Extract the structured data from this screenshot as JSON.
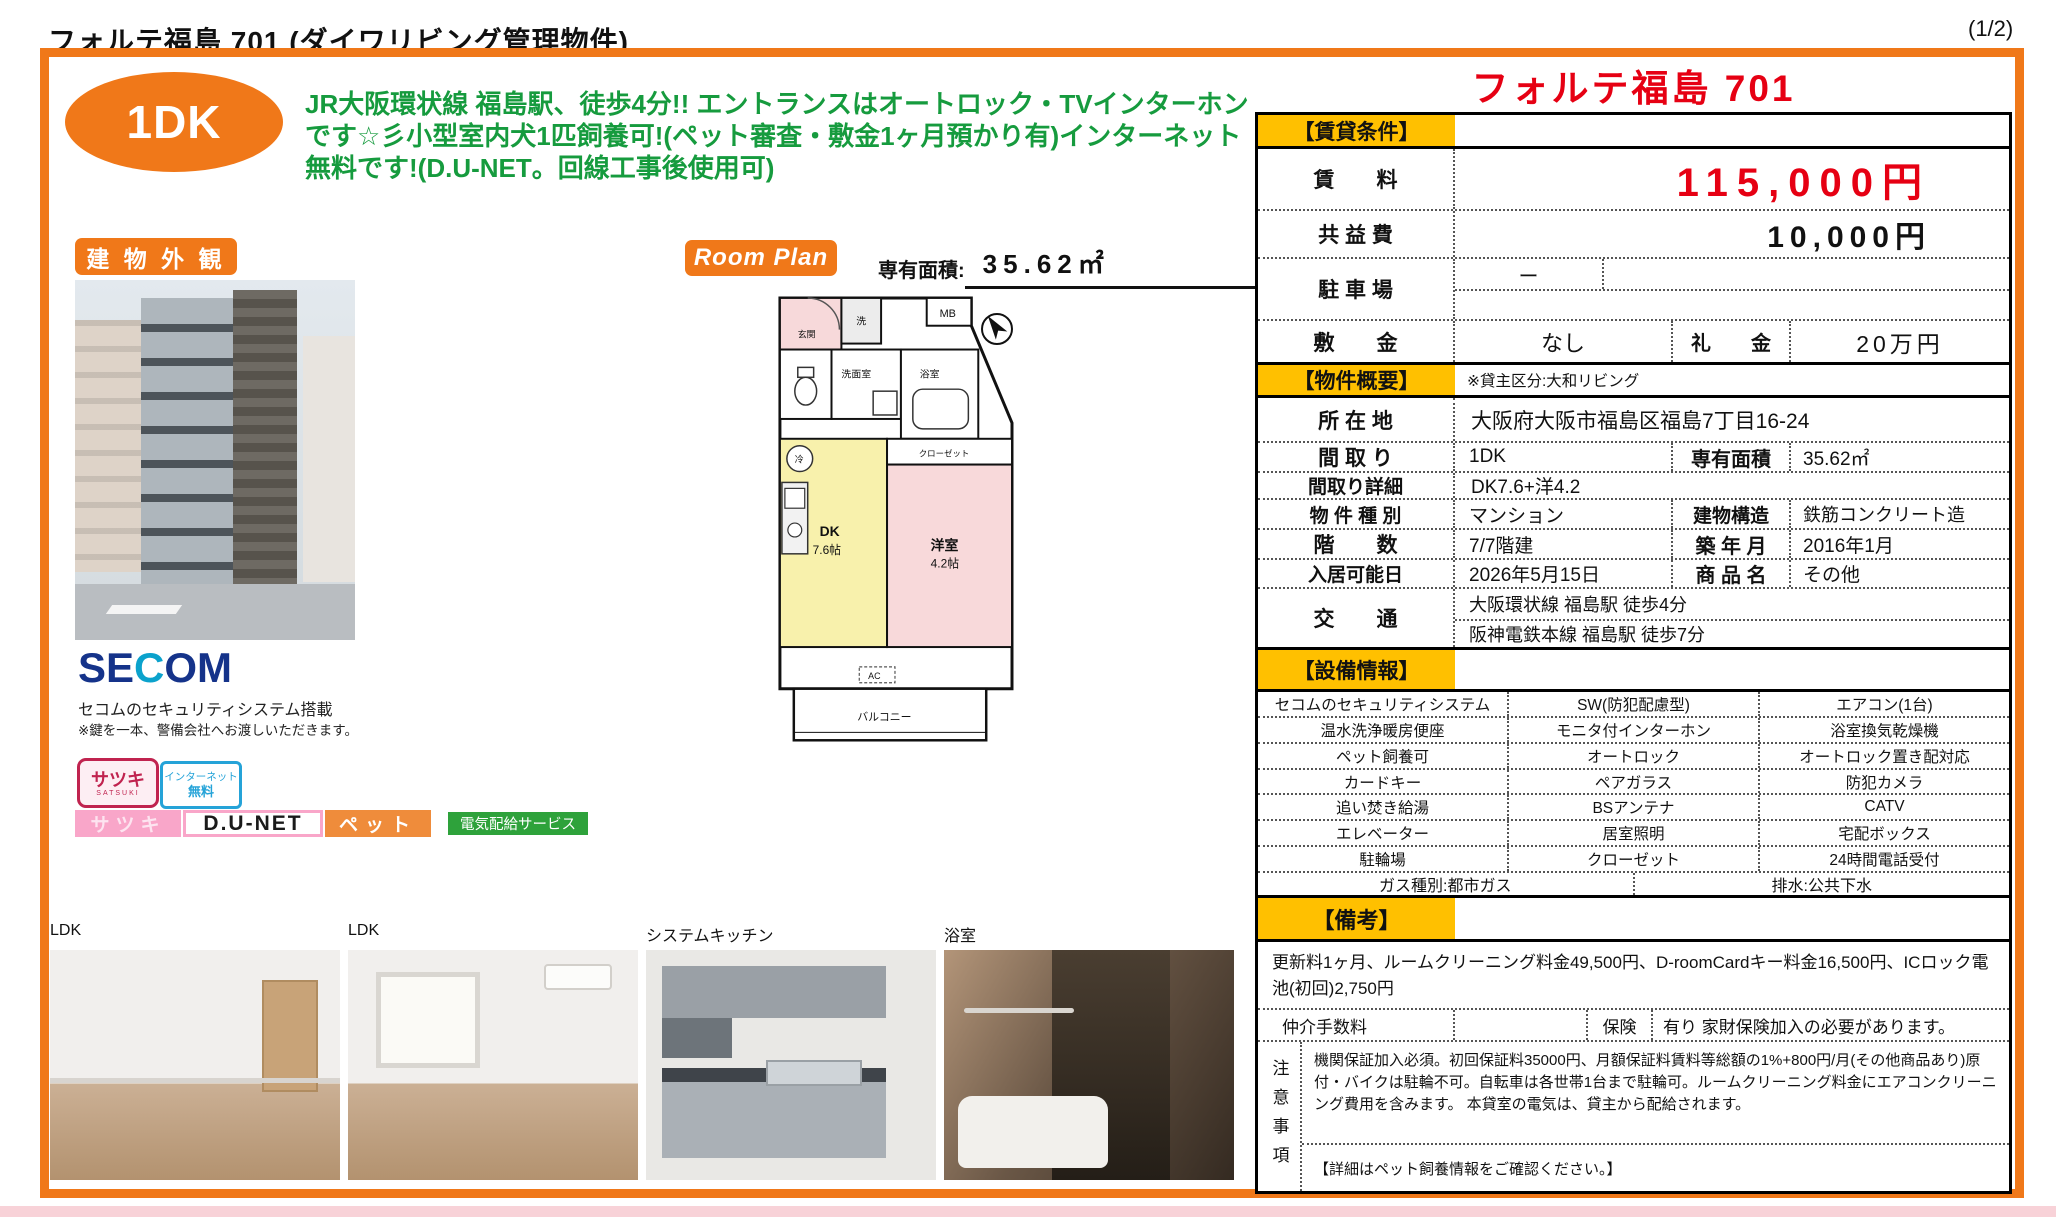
{
  "colors": {
    "frame_orange": "#f07819",
    "section_yellow": "#ffc000",
    "price_red": "#e60013",
    "headline_green": "#169b3e",
    "secom_blue": "#15338a",
    "secom_teal": "#0ba2cc",
    "badge_pink": "#f9a6c9",
    "badge_orange": "#ef8c3b",
    "badge_green": "#2ea23b"
  },
  "header": {
    "title": "フォルテ福島 701 (ダイワリビング管理物件)",
    "page": "(1/2)"
  },
  "hero": {
    "type_badge": "1DK",
    "headline": "JR大阪環状線 福島駅、徒歩4分!! エントランスはオートロック・TVインターホンです☆彡小型室内犬1匹飼養可!(ペット審査・敷金1ヶ月預かり有)インターネット無料です!(D.U-NET。回線工事後使用可)"
  },
  "left": {
    "exterior_label": "建 物 外 観",
    "secom": {
      "logo_parts": [
        "SE",
        "C",
        "OM"
      ],
      "line1": "セコムのセキュリティシステム搭載",
      "line2": "※鍵を一本、警備会社へお渡しいただきます。"
    },
    "badges": {
      "satsuki_stamp": "サツキ",
      "satsuki_sub": "SATSUKI",
      "internet1": "インターネット",
      "internet2": "無料",
      "satsuki_bar": "サツキ",
      "dunet": "D.U-NET",
      "pet": "ペット",
      "electric": "電気配給サービス"
    }
  },
  "floorplan": {
    "label": "Room Plan",
    "area_label": "専有面積:",
    "area_value": "35.62㎡",
    "rooms": {
      "mb": "MB",
      "entrance": "玄関",
      "washer": "洗",
      "washroom": "洗面室",
      "bath": "浴室",
      "fridge": "冷",
      "closet": "クローゼット",
      "dk": "DK",
      "dk_size": "7.6帖",
      "western": "洋室",
      "western_size": "4.2帖",
      "ac": "AC",
      "balcony": "バルコニー"
    }
  },
  "photos": [
    {
      "label": "LDK"
    },
    {
      "label": "LDK"
    },
    {
      "label": "システムキッチン"
    },
    {
      "label": "浴室"
    }
  ],
  "panel": {
    "title": "フォルテ福島 701",
    "sec_rental": "【賃貸条件】",
    "rent_label": "賃　　料",
    "rent_value": "115,000円",
    "fee_label": "共 益 費",
    "fee_value": "10,000円",
    "parking_label": "駐 車 場",
    "parking_value": "ー",
    "deposit_label": "敷　　金",
    "deposit_value": "なし",
    "key_label": "礼　　金",
    "key_value": "20万円",
    "sec_overview": "【物件概要】",
    "overview_note": "※貸主区分:大和リビング",
    "address_label": "所 在 地",
    "address_value": "大阪府大阪市福島区福島7丁目16-24",
    "layout_label": "間 取 り",
    "layout_value": "1DK",
    "area_label": "専有面積",
    "area_value": "35.62㎡",
    "detail_label": "間取り詳細",
    "detail_value": "DK7.6+洋4.2",
    "type_label": "物 件 種 別",
    "type_value": "マンション",
    "structure_label": "建物構造",
    "structure_value": "鉄筋コンクリート造",
    "floors_label": "階　　数",
    "floors_value": "7/7階建",
    "built_label": "築 年 月",
    "built_value": "2016年1月",
    "movein_label": "入居可能日",
    "movein_value": "2026年5月15日",
    "product_label": "商 品 名",
    "product_value": "その他",
    "access_label": "交　　通",
    "access1": "大阪環状線 福島駅 徒歩4分",
    "access2": "阪神電鉄本線 福島駅 徒歩7分",
    "sec_equipment": "【設備情報】",
    "equipment": [
      [
        "セコムのセキュリティシステム",
        "SW(防犯配慮型)",
        "エアコン(1台)"
      ],
      [
        "温水洗浄暖房便座",
        "モニタ付インターホン",
        "浴室換気乾燥機"
      ],
      [
        "ペット飼養可",
        "オートロック",
        "オートロック置き配対応"
      ],
      [
        "カードキー",
        "ペアガラス",
        "防犯カメラ"
      ],
      [
        "追い焚き給湯",
        "BSアンテナ",
        "CATV"
      ],
      [
        "エレベーター",
        "居室照明",
        "宅配ボックス"
      ],
      [
        "駐輪場",
        "クローゼット",
        "24時間電話受付"
      ]
    ],
    "gas": "ガス種別:都市ガス",
    "drain": "排水:公共下水",
    "sec_remarks": "【備考】",
    "remarks": "更新料1ヶ月、ルームクリーニング料金49,500円、D-roomCardキー料金16,500円、ICロック電池(初回)2,750円",
    "broker_label": "仲介手数料",
    "insurance_label": "保険",
    "insurance_value": "有り 家財保険加入の必要があります。",
    "caution_label": "注意事項",
    "caution1": "機関保証加入必須。初回保証料35000円、月額保証料賃料等総額の1%+800円/月(その他商品あり)原付・バイクは駐輪不可。自転車は各世帯1台まで駐輪可。ルームクリーニング料金にエアコンクリーニング費用を含みます。 本貸室の電気は、貸主から配給されます。",
    "caution2": "【詳細はペット飼養情報をご確認ください。】"
  }
}
